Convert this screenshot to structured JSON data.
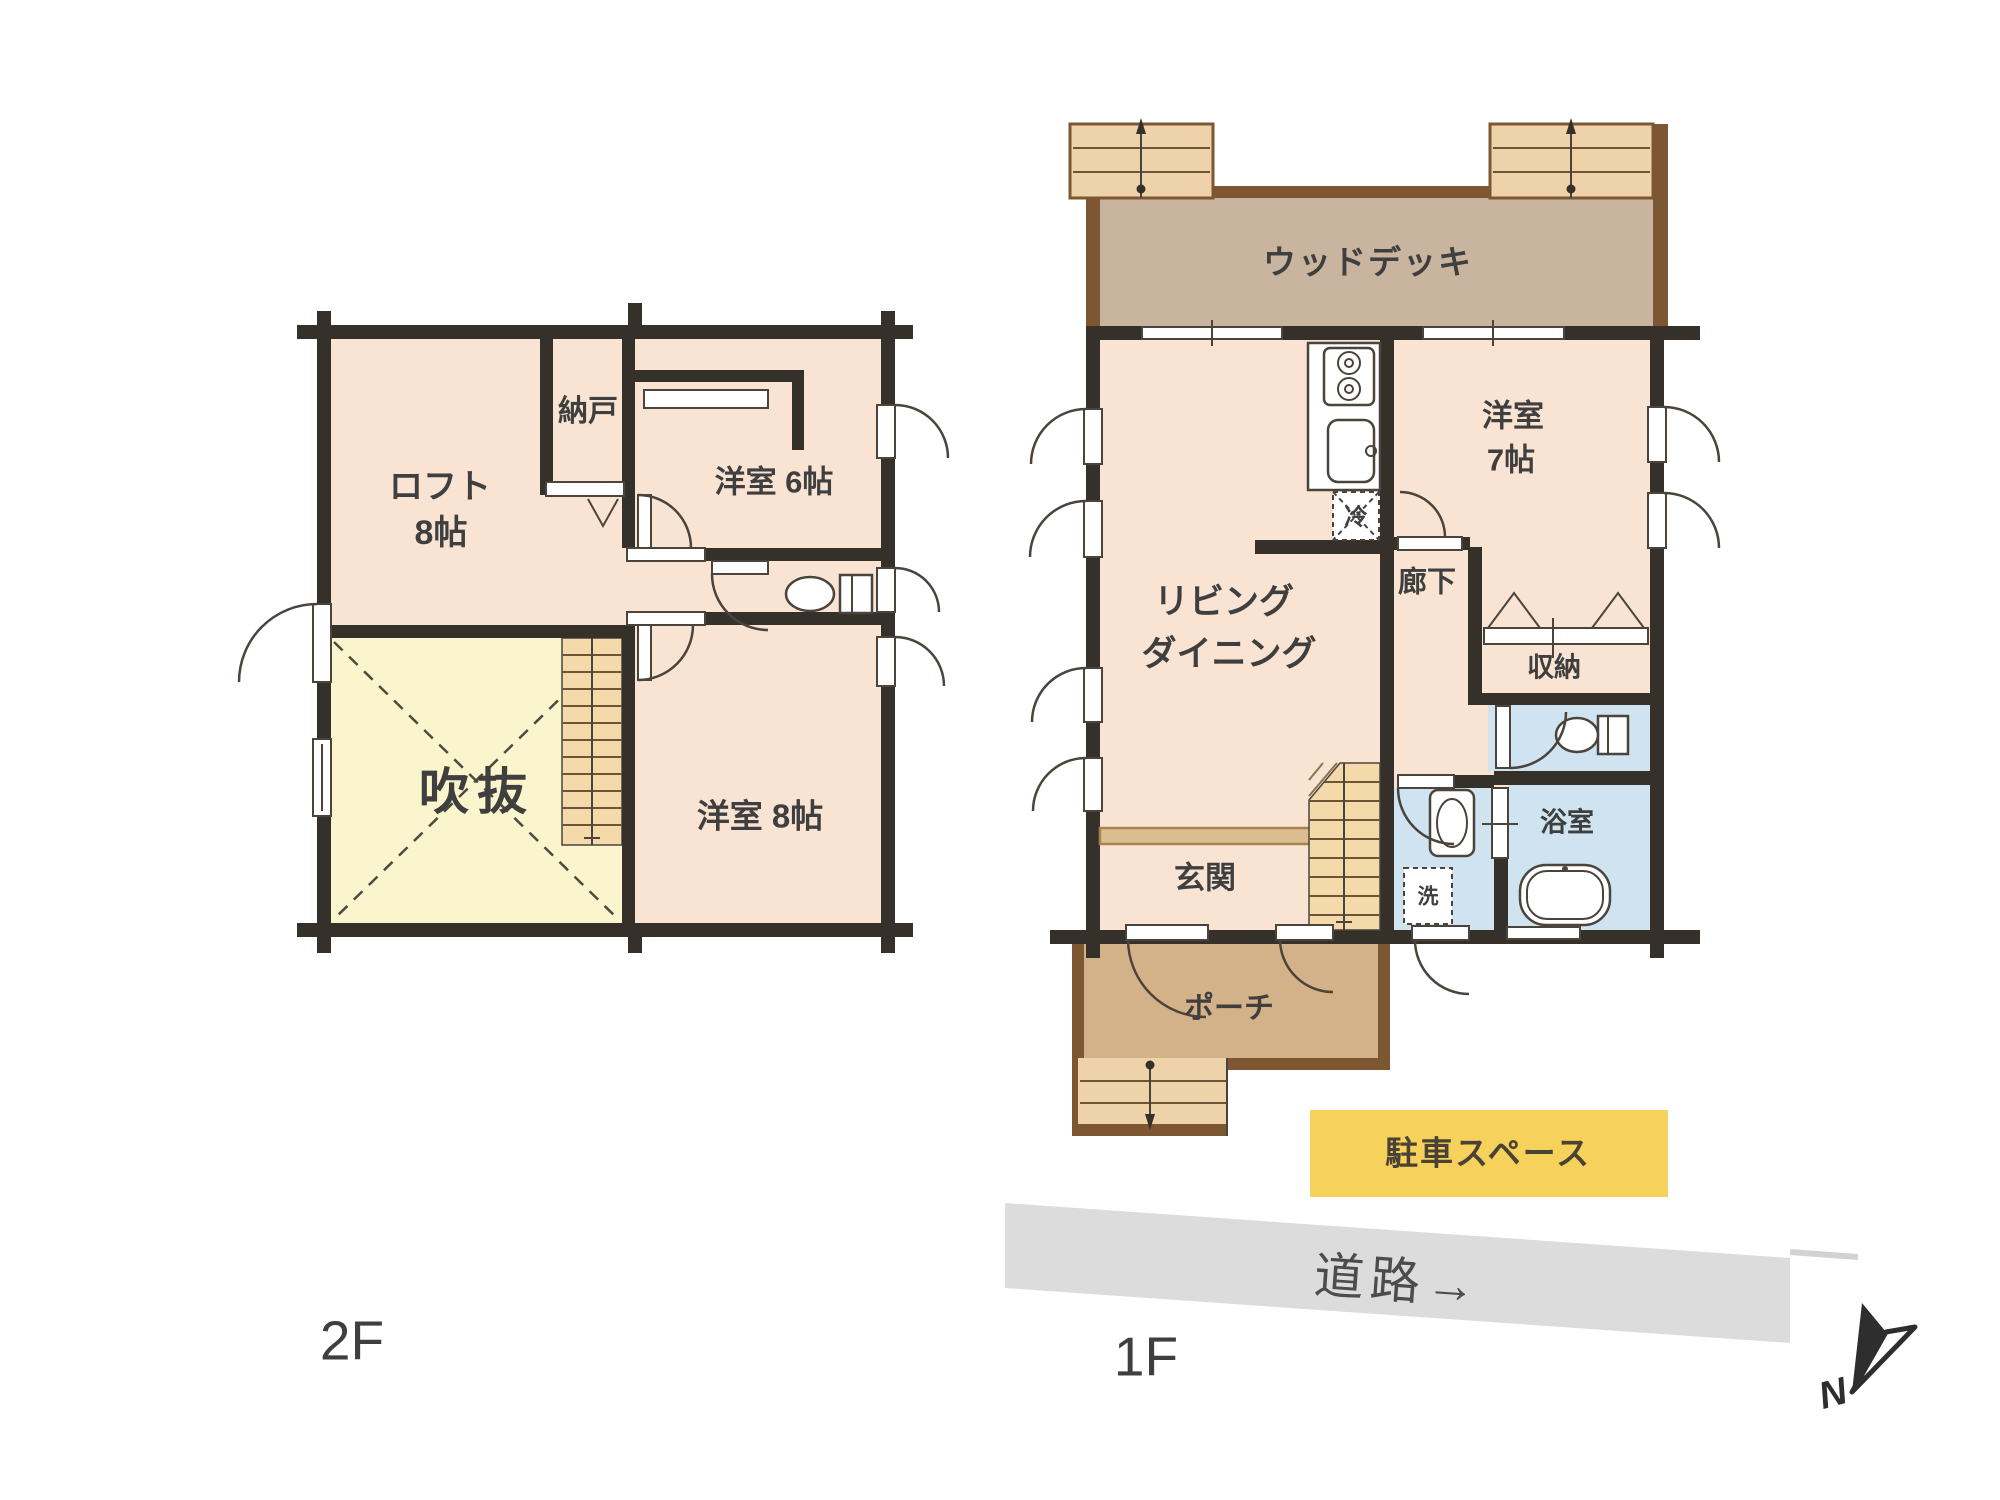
{
  "floor2": {
    "label": "2F",
    "loft_name": "ロフト",
    "loft_size": "8帖",
    "storage": "納戸",
    "western6": "洋室 6帖",
    "atrium": "吹抜",
    "western8": "洋室 8帖"
  },
  "floor1": {
    "label": "1F",
    "wood_deck": "ウッドデッキ",
    "western7_name": "洋室",
    "western7_size": "7帖",
    "living_line1": "リビング",
    "living_line2": "ダイニング",
    "hallway": "廊下",
    "closet": "収納",
    "bathroom": "浴室",
    "fridge": "冷",
    "washer": "洗",
    "entrance": "玄関",
    "porch": "ポーチ"
  },
  "site": {
    "parking": "駐車スペース",
    "road": "道路→",
    "north": "N"
  },
  "colors": {
    "wall": "#36302a",
    "room": "#f9e4d3",
    "atrium": "#fbf5cd",
    "wet": "#cfe3f0",
    "deck": "#c9b4a0",
    "deckEdge": "#7d5731",
    "porch": "#d3b28a",
    "steps": "#eed3aa",
    "stairs": "#f4d9ab",
    "entry": "#dcbd90",
    "entryEdge": "#a9834f",
    "parking": "#f6d15b",
    "road": "#dcdcdc",
    "ink": "#3f3f3f"
  }
}
